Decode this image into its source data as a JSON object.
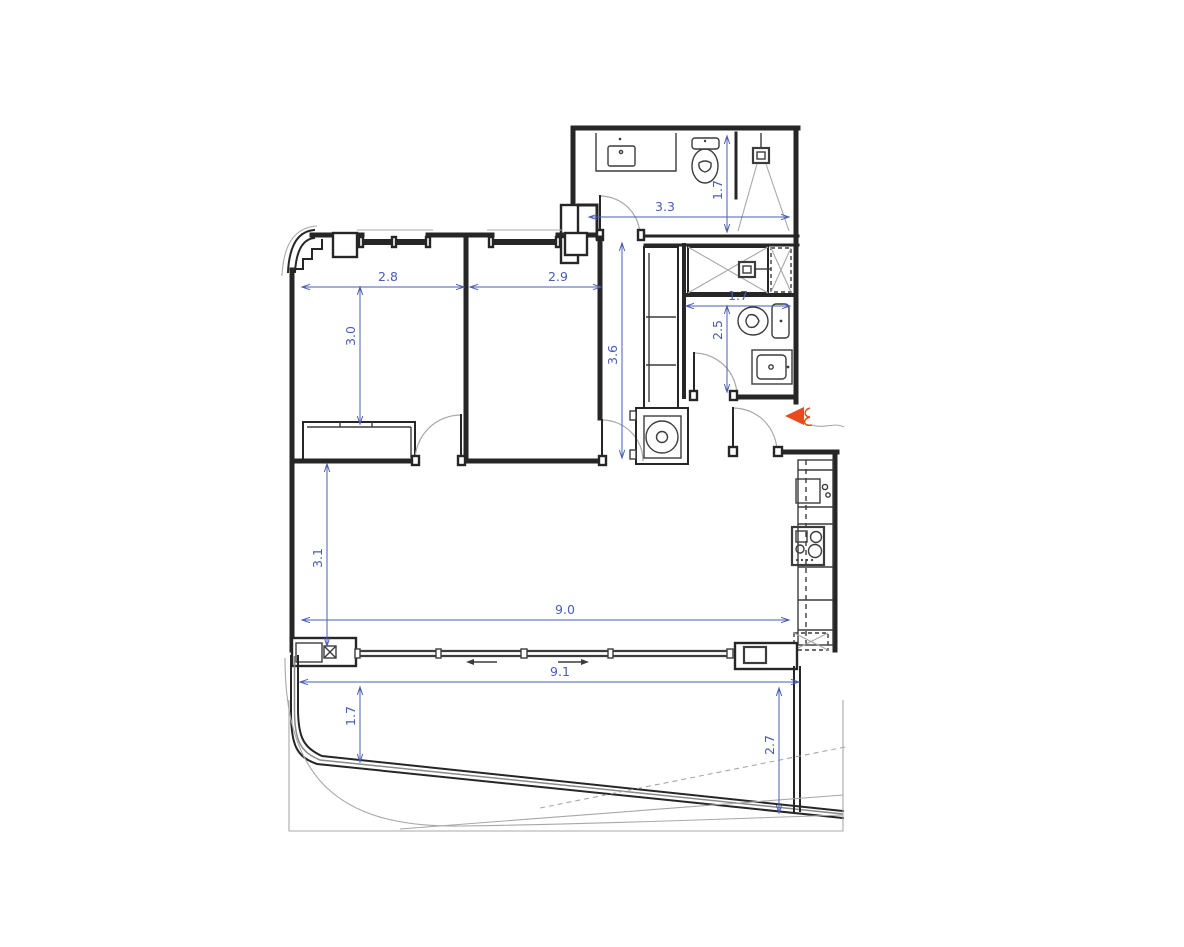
{
  "meta": {
    "drawing_type": "apartment floor plan",
    "units": "m"
  },
  "colors": {
    "wall": "#262626",
    "fixture": "#3c3c3c",
    "light": "#a8a8a8",
    "dimension": "#4a5db5",
    "entrance": "#e8491d",
    "background": "#ffffff"
  },
  "dimensions": [
    {
      "id": "bath1-width",
      "label": "3.3",
      "x1": 589,
      "y1": 217,
      "x2": 789,
      "y2": 217,
      "label_x": 665,
      "label_y": 211,
      "rotate": false
    },
    {
      "id": "bath1-depth",
      "label": "1.7",
      "x1": 727,
      "y1": 136,
      "x2": 727,
      "y2": 232,
      "label_x": 722,
      "label_y": 190,
      "rotate": true
    },
    {
      "id": "bedroom1-width",
      "label": "2.8",
      "x1": 302,
      "y1": 287,
      "x2": 464,
      "y2": 287,
      "label_x": 388,
      "label_y": 281,
      "rotate": false
    },
    {
      "id": "bedroom2-width",
      "label": "2.9",
      "x1": 470,
      "y1": 287,
      "x2": 601,
      "y2": 287,
      "label_x": 558,
      "label_y": 281,
      "rotate": false
    },
    {
      "id": "bedroom1-depth",
      "label": "3.0",
      "x1": 360,
      "y1": 287,
      "x2": 360,
      "y2": 424,
      "label_x": 355,
      "label_y": 336,
      "rotate": true
    },
    {
      "id": "hall-length",
      "label": "3.6",
      "x1": 622,
      "y1": 243,
      "x2": 622,
      "y2": 458,
      "label_x": 617,
      "label_y": 355,
      "rotate": true
    },
    {
      "id": "bath2-width",
      "label": "1.7",
      "x1": 686,
      "y1": 306,
      "x2": 790,
      "y2": 306,
      "label_x": 738,
      "label_y": 300,
      "rotate": false
    },
    {
      "id": "bath2-depth",
      "label": "2.5",
      "x1": 727,
      "y1": 306,
      "x2": 727,
      "y2": 392,
      "label_x": 722,
      "label_y": 330,
      "rotate": true
    },
    {
      "id": "living-width",
      "label": "9.0",
      "x1": 302,
      "y1": 620,
      "x2": 789,
      "y2": 620,
      "label_x": 565,
      "label_y": 614,
      "rotate": false
    },
    {
      "id": "living-depth",
      "label": "3.1",
      "x1": 327,
      "y1": 464,
      "x2": 327,
      "y2": 646,
      "label_x": 322,
      "label_y": 558,
      "rotate": true
    },
    {
      "id": "balcony-width",
      "label": "9.1",
      "x1": 300,
      "y1": 682,
      "x2": 799,
      "y2": 682,
      "label_x": 560,
      "label_y": 676,
      "rotate": false
    },
    {
      "id": "balcony-depth-left",
      "label": "1.7",
      "x1": 360,
      "y1": 687,
      "x2": 360,
      "y2": 762,
      "label_x": 355,
      "label_y": 716,
      "rotate": true
    },
    {
      "id": "balcony-depth-right",
      "label": "2.7",
      "x1": 779,
      "y1": 688,
      "x2": 779,
      "y2": 813,
      "label_x": 774,
      "label_y": 745,
      "rotate": true
    }
  ],
  "annotations": {
    "entrance_marker": "entrance-arrow",
    "slide_direction_left": "arrow-left",
    "slide_direction_right": "arrow-right"
  },
  "fixtures": {
    "bathroom1": [
      "sink-icon",
      "toilet-icon",
      "shower-icon"
    ],
    "bathroom2": [
      "shower-icon",
      "shaft-hatch",
      "toilet-icon",
      "sink-icon"
    ],
    "kitchen": [
      "kitchen-sink-icon",
      "cooktop-icon",
      "column-hatch"
    ],
    "utility": [
      "washing-machine-icon",
      "wardrobe"
    ],
    "openings": [
      "sliding-door",
      "entrance-door",
      "window"
    ]
  }
}
